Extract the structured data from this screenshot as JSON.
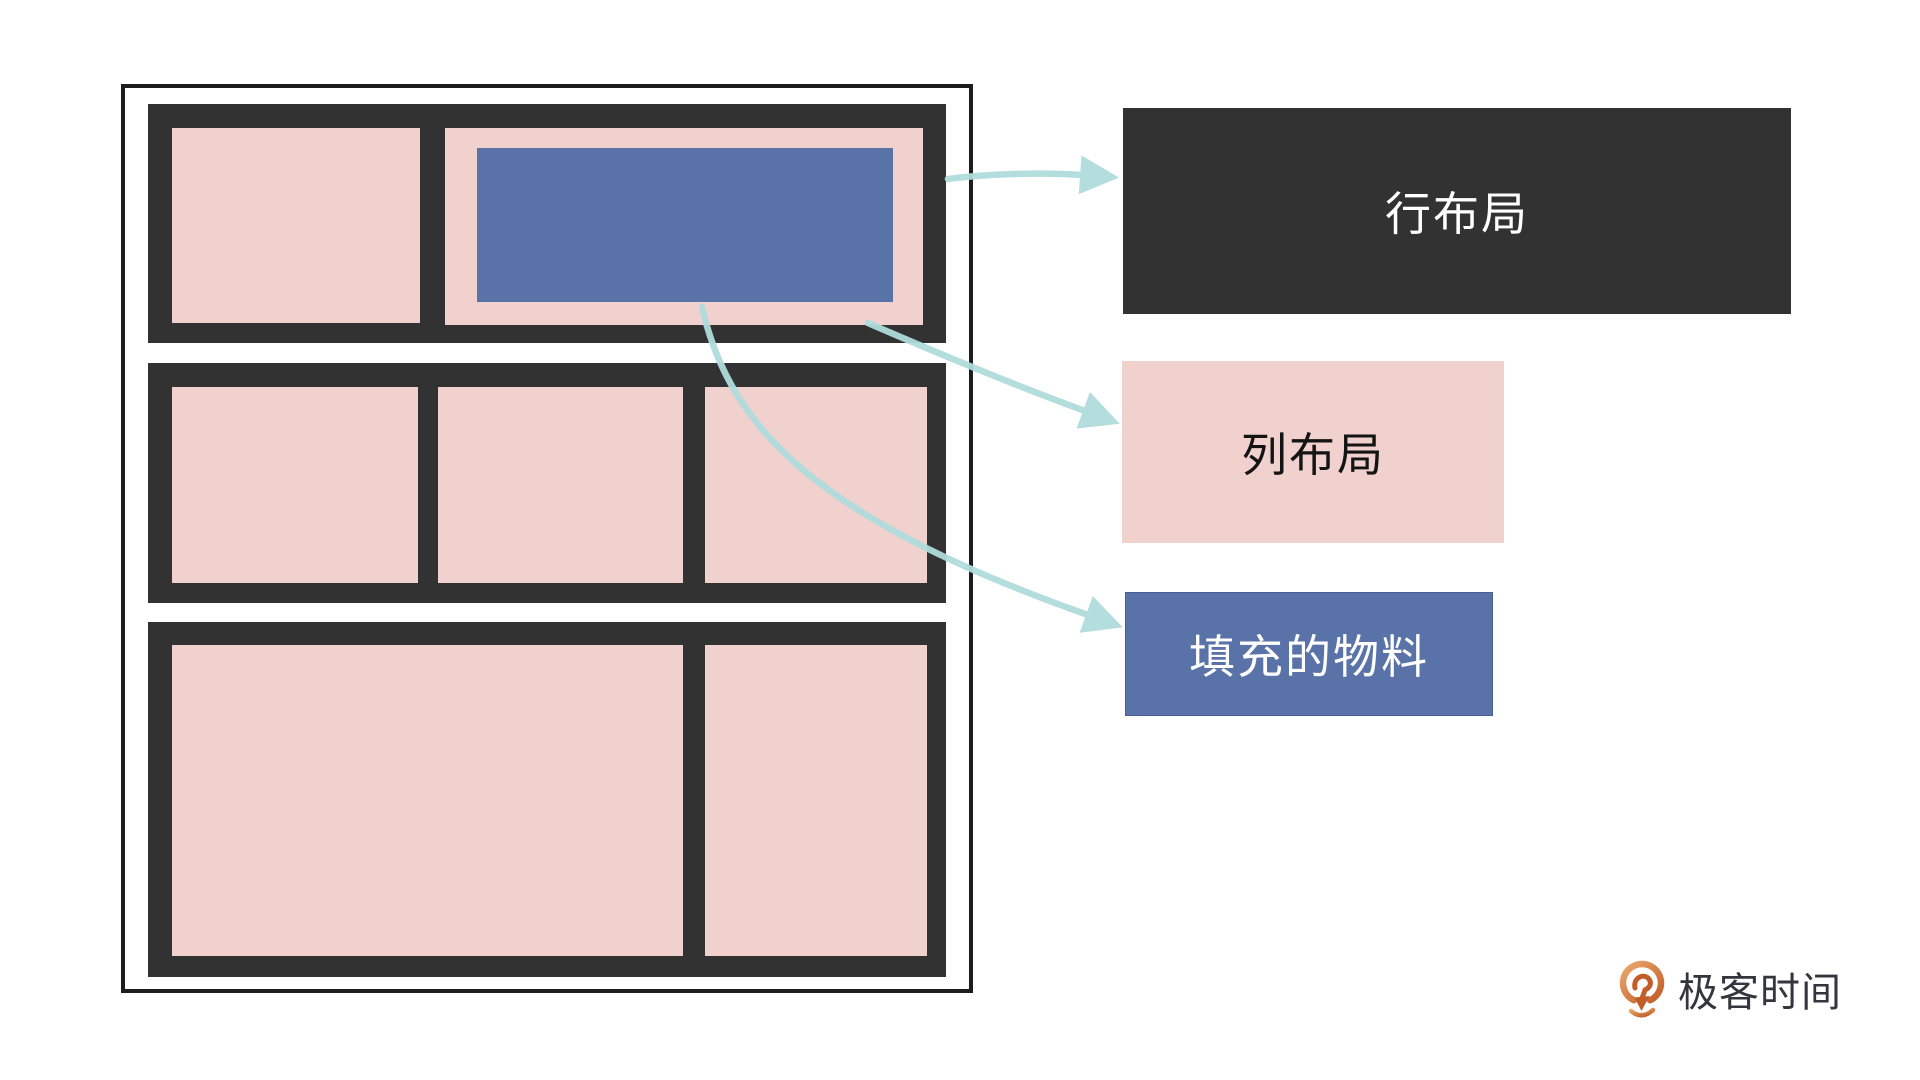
{
  "legend": {
    "row_layout": {
      "label": "行布局"
    },
    "column_layout": {
      "label": "列布局"
    },
    "fill_material": {
      "label": "填充的物料"
    }
  },
  "logo": {
    "brand": "极客时间"
  },
  "colors": {
    "pink": "#f0d1ce",
    "blue": "#5972a8",
    "dark": "#323232",
    "frame_border": "#1d1d1d",
    "arrow": "#b0dcdc",
    "label_text_light": "#ffffff",
    "label_text_dark": "#141414",
    "logo_orange_light": "#e9a96d",
    "logo_orange_dark": "#c25d28",
    "logo_text": "#35353d"
  },
  "diagram": {
    "rows": [
      {
        "name": "row-1",
        "cells": [
          {
            "type": "column"
          },
          {
            "type": "column",
            "contains": "fill-material"
          }
        ]
      },
      {
        "name": "row-2",
        "cells": [
          {
            "type": "column"
          },
          {
            "type": "column"
          },
          {
            "type": "column"
          }
        ]
      },
      {
        "name": "row-3",
        "cells": [
          {
            "type": "column-wide"
          },
          {
            "type": "column"
          }
        ]
      }
    ]
  }
}
